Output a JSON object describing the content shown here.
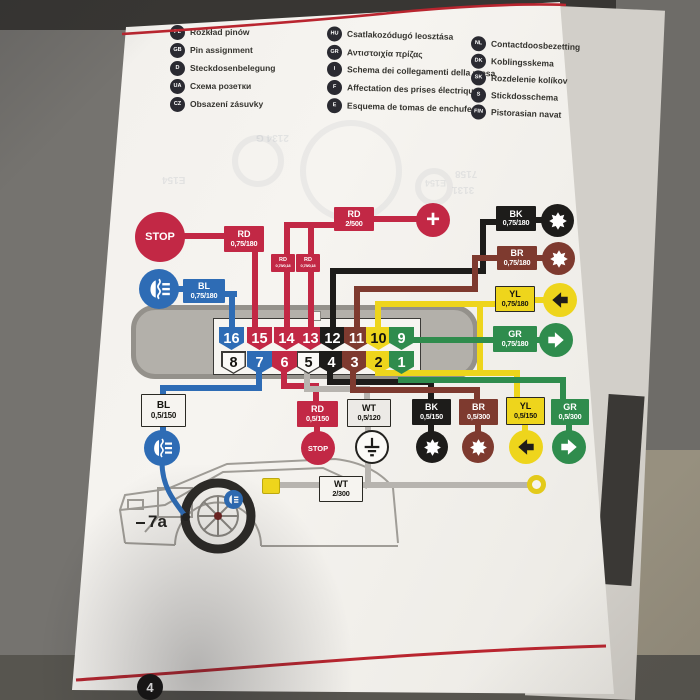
{
  "page": {
    "number_badge": "4"
  },
  "legend": {
    "col1": [
      {
        "code": "PL",
        "label": "Rozkład pinów"
      },
      {
        "code": "GB",
        "label": "Pin assignment"
      },
      {
        "code": "D",
        "label": "Steckdosenbelegung"
      },
      {
        "code": "UA",
        "label": "Схема розетки"
      },
      {
        "code": "CZ",
        "label": "Obsazení zásuvky"
      }
    ],
    "col2": [
      {
        "code": "HU",
        "label": "Csatlakozódugó leosztása"
      },
      {
        "code": "GR",
        "label": "Αντιστοιχία πρίζας"
      },
      {
        "code": "I",
        "label": "Schema dei collegamenti della presa"
      },
      {
        "code": "F",
        "label": "Affectation des prises électriques"
      },
      {
        "code": "E",
        "label": "Esquema de tomas de enchufe"
      }
    ],
    "col3": [
      {
        "code": "NL",
        "label": "Contactdoosbezetting"
      },
      {
        "code": "DK",
        "label": "Koblingsskema"
      },
      {
        "code": "SK",
        "label": "Rozdelenie kolíkov"
      },
      {
        "code": "S",
        "label": "Stickdosschema"
      },
      {
        "code": "FIN",
        "label": "Pistorasian navat"
      }
    ]
  },
  "diagram": {
    "top_labels": {
      "rd_stop": {
        "code": "RD",
        "spec": "0,75/180"
      },
      "rd_plus": {
        "code": "RD",
        "spec": "2/500"
      },
      "bl": {
        "code": "BL",
        "spec": "0,75/180"
      },
      "bk": {
        "code": "BK",
        "spec": "0,75/180"
      },
      "br": {
        "code": "BR",
        "spec": "0,75/180"
      },
      "yl": {
        "code": "YL",
        "spec": "0,75/180"
      },
      "gr": {
        "code": "GR",
        "spec": "0,75/180"
      },
      "jumper1": {
        "code": "RD",
        "spec": "0,75/0,18"
      },
      "jumper2": {
        "code": "RD",
        "spec": "0,75/0,18"
      }
    },
    "bottom_labels": {
      "bl": {
        "code": "BL",
        "spec": "0,5/150"
      },
      "rd": {
        "code": "RD",
        "spec": "0,5/150"
      },
      "wt": {
        "code": "WT",
        "spec": "0,5/120"
      },
      "bk": {
        "code": "BK",
        "spec": "0,5/150"
      },
      "br": {
        "code": "BR",
        "spec": "0,5/300"
      },
      "yl": {
        "code": "YL",
        "spec": "0,5/150"
      },
      "gr": {
        "code": "GR",
        "spec": "0,5/300"
      },
      "wt_main": {
        "code": "WT",
        "spec": "2/300"
      }
    },
    "connector": {
      "top_pins": [
        {
          "n": "16",
          "color": "blue"
        },
        {
          "n": "15",
          "color": "red"
        },
        {
          "n": "14",
          "color": "red"
        },
        {
          "n": "13",
          "color": "red"
        },
        {
          "n": "12",
          "color": "black"
        },
        {
          "n": "11",
          "color": "brown"
        },
        {
          "n": "10",
          "color": "yellow"
        },
        {
          "n": "9",
          "color": "green"
        }
      ],
      "bottom_pins": [
        {
          "n": "8",
          "color": "white"
        },
        {
          "n": "7",
          "color": "blue"
        },
        {
          "n": "6",
          "color": "red"
        },
        {
          "n": "5",
          "color": "white"
        },
        {
          "n": "4",
          "color": "black"
        },
        {
          "n": "3",
          "color": "brown"
        },
        {
          "n": "2",
          "color": "yellow"
        },
        {
          "n": "1",
          "color": "green"
        }
      ]
    },
    "texts": {
      "stop_top": "STOP",
      "stop_bottom": "STOP",
      "plus": "+",
      "car_ref": "7a"
    },
    "ghost_texts": [
      "2134 G",
      "E154",
      "7158",
      "3131",
      "E154"
    ]
  },
  "colors": {
    "red": "#c22845",
    "blue": "#2e6cb5",
    "black": "#1d1c1a",
    "brown": "#7e3a2f",
    "yellow": "#eed51c",
    "green": "#2f8c4d",
    "white_wire": "#b7b4af",
    "page_rule_red": "#b9252f"
  }
}
